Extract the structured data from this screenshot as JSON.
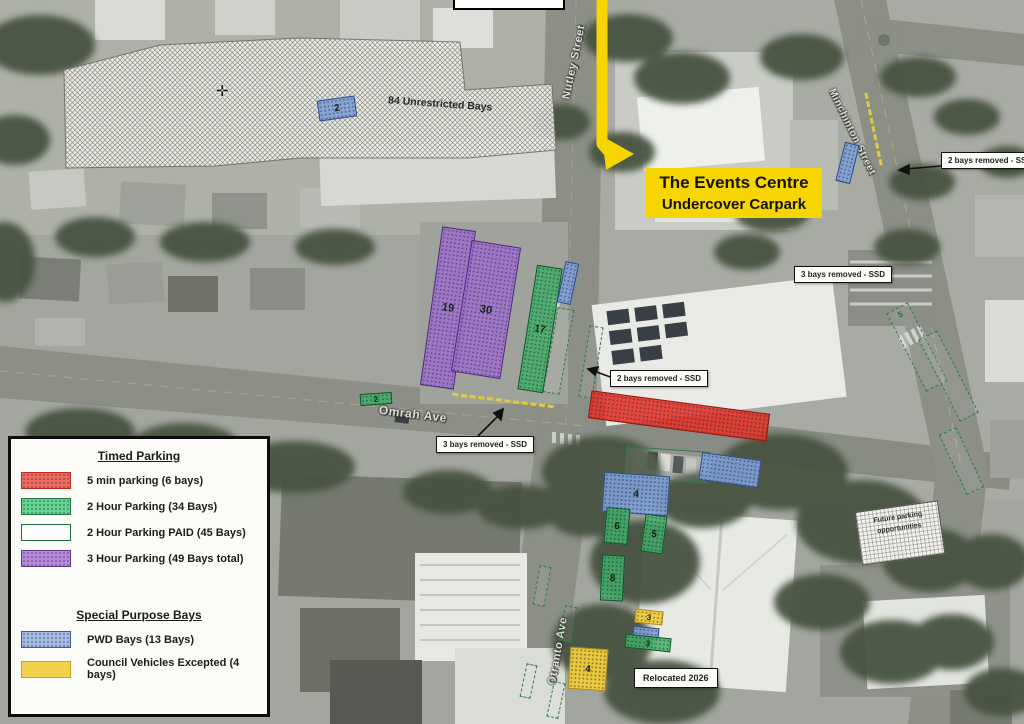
{
  "map": {
    "streets": {
      "nutley": "Nutley Street",
      "minchinton": "Minchinton Street",
      "omrah": "Omrah Ave",
      "otranto": "Otranto Ave"
    },
    "highlight": {
      "line1": "The Events Centre",
      "line2": "Undercover Carpark"
    },
    "callouts": {
      "unrestricted": "84 Unrestricted Bays",
      "removed2_top_right": "2 bays removed - SSD",
      "removed3_right": "3 bays removed - SSD",
      "removed2_mid": "2 bays removed - SSD",
      "removed3_omrah": "3 bays removed - SSD",
      "future_line1": "Future parking",
      "future_line2": "opportunities",
      "relocated": "Relocated 2026"
    },
    "counts": {
      "unrestricted_pwd": "2",
      "purple_west": "19",
      "purple_east": "30",
      "green_strip": "17",
      "omrah_green": "2",
      "pwd_block": "4",
      "green_a": "6",
      "green_b": "5",
      "green_c": "8",
      "yellow_small": "3",
      "green_small": "3",
      "yellow_block": "4",
      "paid_right": "5"
    }
  },
  "legend": {
    "timed_title": "Timed Parking",
    "timed_items": [
      {
        "label": "5 min parking (6 bays)",
        "color": "#e0352b"
      },
      {
        "label": "2 Hour Parking (34 Bays)",
        "color": "#3fae68"
      },
      {
        "label": "2 Hour Parking PAID (45 Bays)",
        "color": "#ffffff",
        "border": "#1d6b40"
      },
      {
        "label": "3 Hour Parking (49 Bays total)",
        "color": "#9e6fd0"
      }
    ],
    "special_title": "Special Purpose Bays",
    "special_items": [
      {
        "label": "PWD Bays (13 Bays)",
        "color": "#7d9fd6"
      },
      {
        "label": "Council Vehicles Excepted (4 bays)",
        "color": "#eecc3c"
      }
    ]
  },
  "colors": {
    "highlight_yellow": "#f6d500",
    "removed_kerb_yellow": "#e3c93c"
  }
}
